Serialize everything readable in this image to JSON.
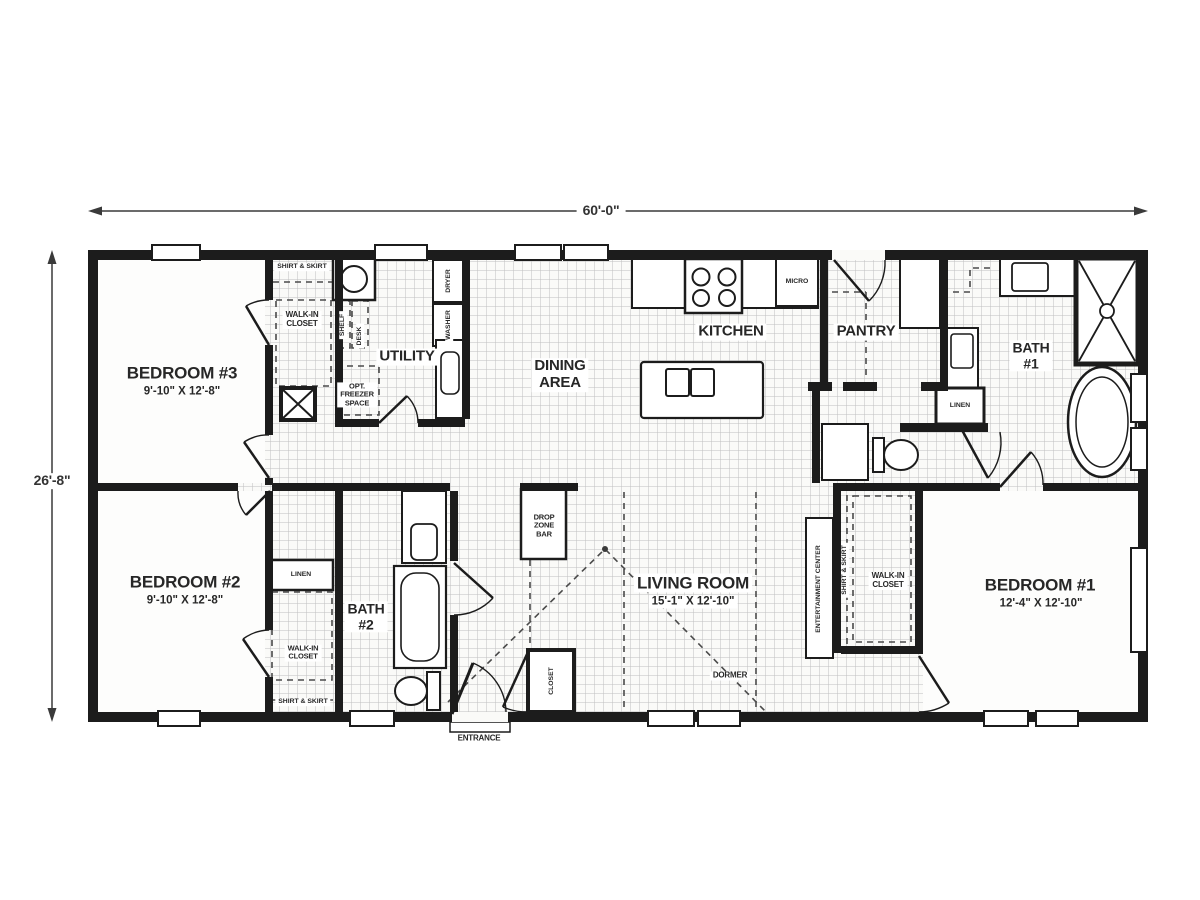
{
  "dims": {
    "width": "60'-0\"",
    "height": "26'-8\""
  },
  "rooms": {
    "bedroom3": {
      "name": "BEDROOM #3",
      "size": "9'-10\" X 12'-8\""
    },
    "bedroom2": {
      "name": "BEDROOM #2",
      "size": "9'-10\" X 12'-8\""
    },
    "bedroom1": {
      "name": "BEDROOM #1",
      "size": "12'-4\" X 12'-10\""
    },
    "living": {
      "name": "LIVING ROOM",
      "size": "15'-1\" X 12'-10\""
    },
    "dining": {
      "name": "DINING\nAREA"
    },
    "kitchen": {
      "name": "KITCHEN"
    },
    "utility": {
      "name": "UTILITY"
    },
    "pantry": {
      "name": "PANTRY"
    },
    "bath1": {
      "name": "BATH\n#1"
    },
    "bath2": {
      "name": "BATH\n#2"
    }
  },
  "labels": {
    "shirt_skirt": "SHIRT & SKIRT",
    "walk_in": "WALK-IN\nCLOSET",
    "shelf": "SHELF",
    "desk": "DESK",
    "opt_freezer": "OPT.\nFREEZER\nSPACE",
    "dryer": "DRYER",
    "washer": "WASHER",
    "micro": "MICRO",
    "linen": "LINEN",
    "drop_zone": "DROP\nZONE\nBAR",
    "closet": "CLOSET",
    "entrance": "ENTRANCE",
    "dormer": "DORMER",
    "entertainment": "ENTERTAINMENT CENTER"
  },
  "colors": {
    "wall": "#1c1c1c",
    "grid": "#bfbfbf",
    "floor": "#fafaf8",
    "room": "#fdfdfc"
  }
}
